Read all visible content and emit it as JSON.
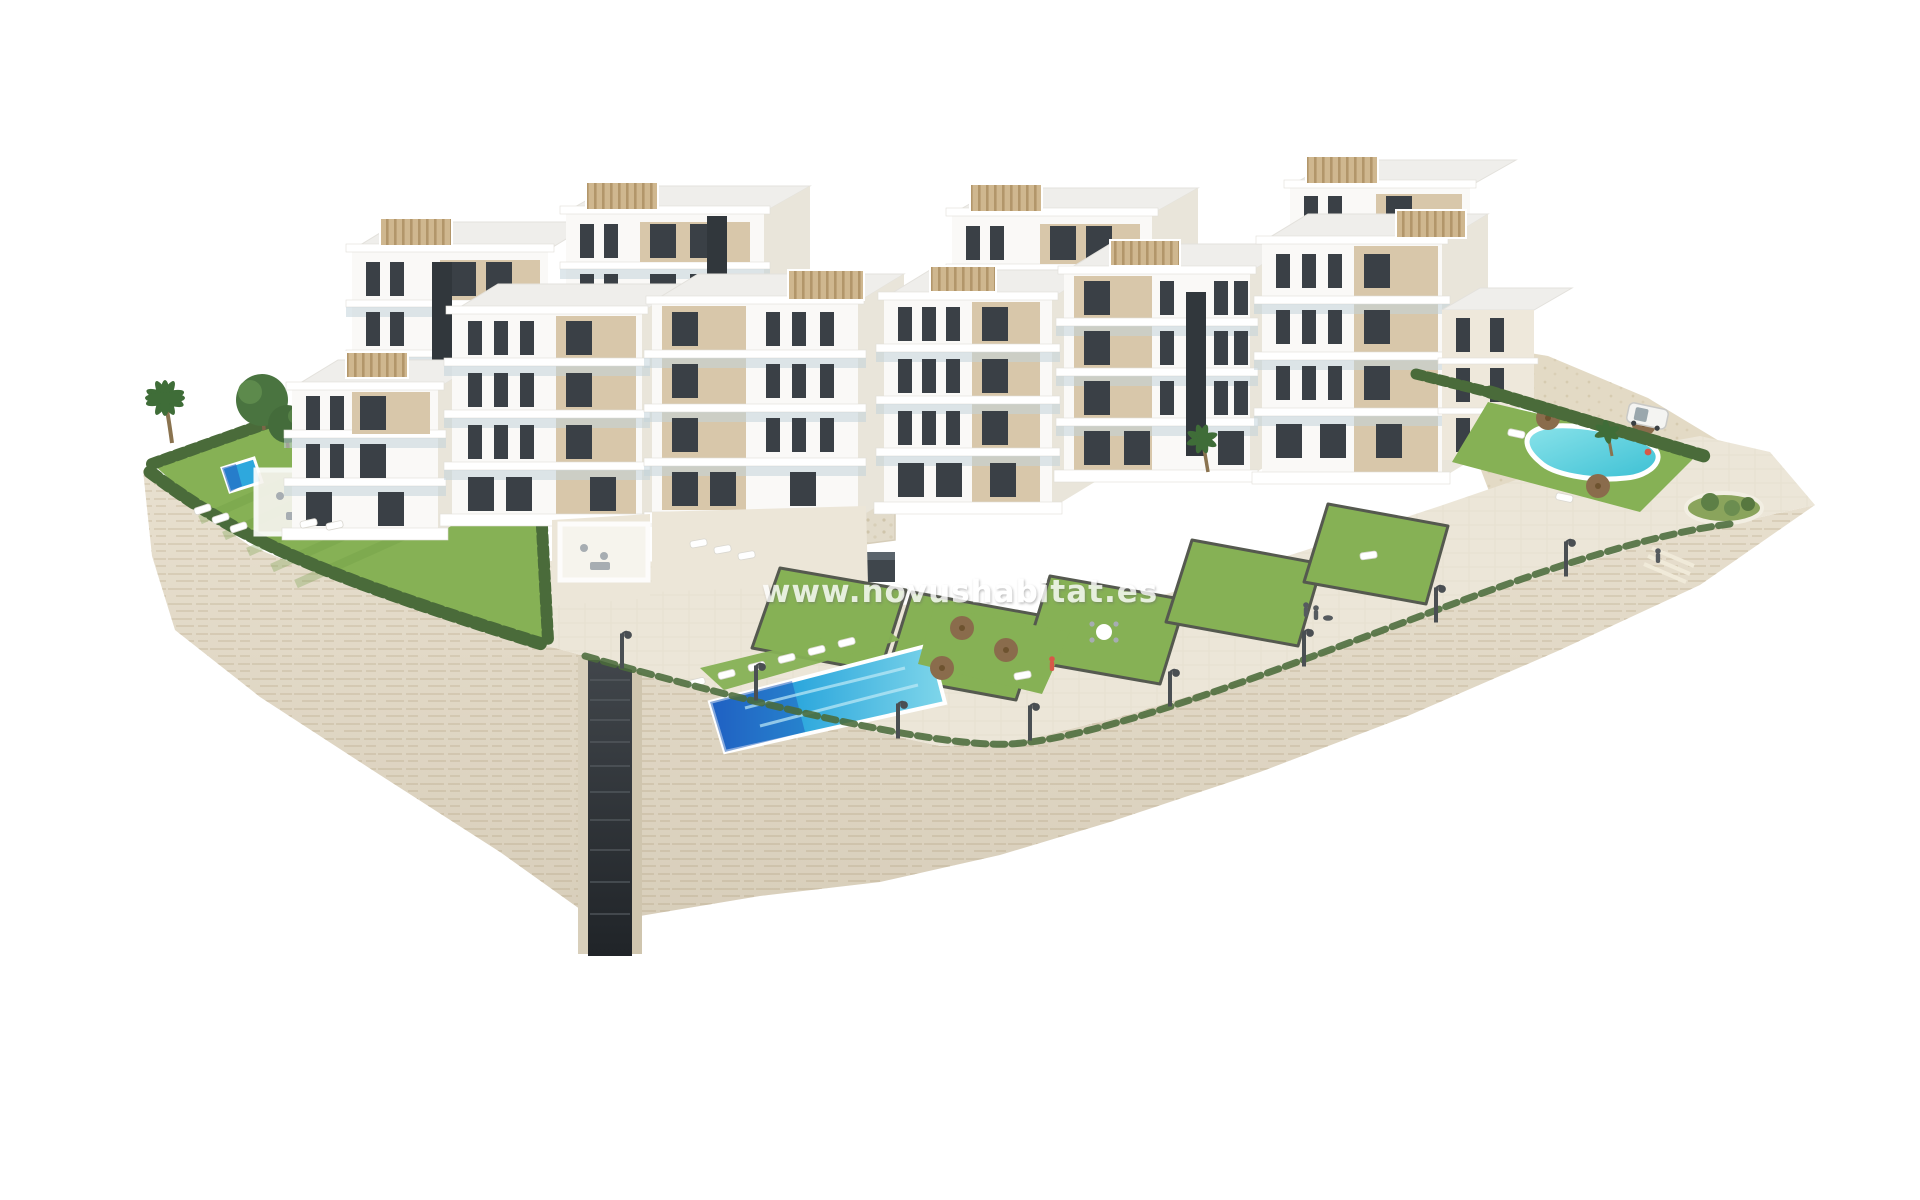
{
  "watermark": {
    "text": "www.novushabitat.es"
  },
  "colors": {
    "background": "#ffffff",
    "wall_stone": "#e8e0cf",
    "stone_line": "#d2c6ae",
    "paving": "#ece6d8",
    "slope": "#e3dac5",
    "lawn": "#86b155",
    "lawn_dark": "#6e9a42",
    "hedge": "#4a6b3a",
    "pool_main": "#2ea8dd",
    "pool_deep": "#2161c0",
    "pool_right": "#55c9d8",
    "white_face": "#faf9f7",
    "cream_face": "#eee8db",
    "beige": "#d8c7aa",
    "window": "#3a4046",
    "glass": "#c2d3da",
    "roof": "#efeeeb",
    "pergola": "#cfb78f",
    "core_dark": "#31373c",
    "parasol": "#8a6c4c",
    "metal": "#4a4f53",
    "figure": "#565b5f",
    "figure_red": "#d85848",
    "watermark": "#ffffff"
  }
}
